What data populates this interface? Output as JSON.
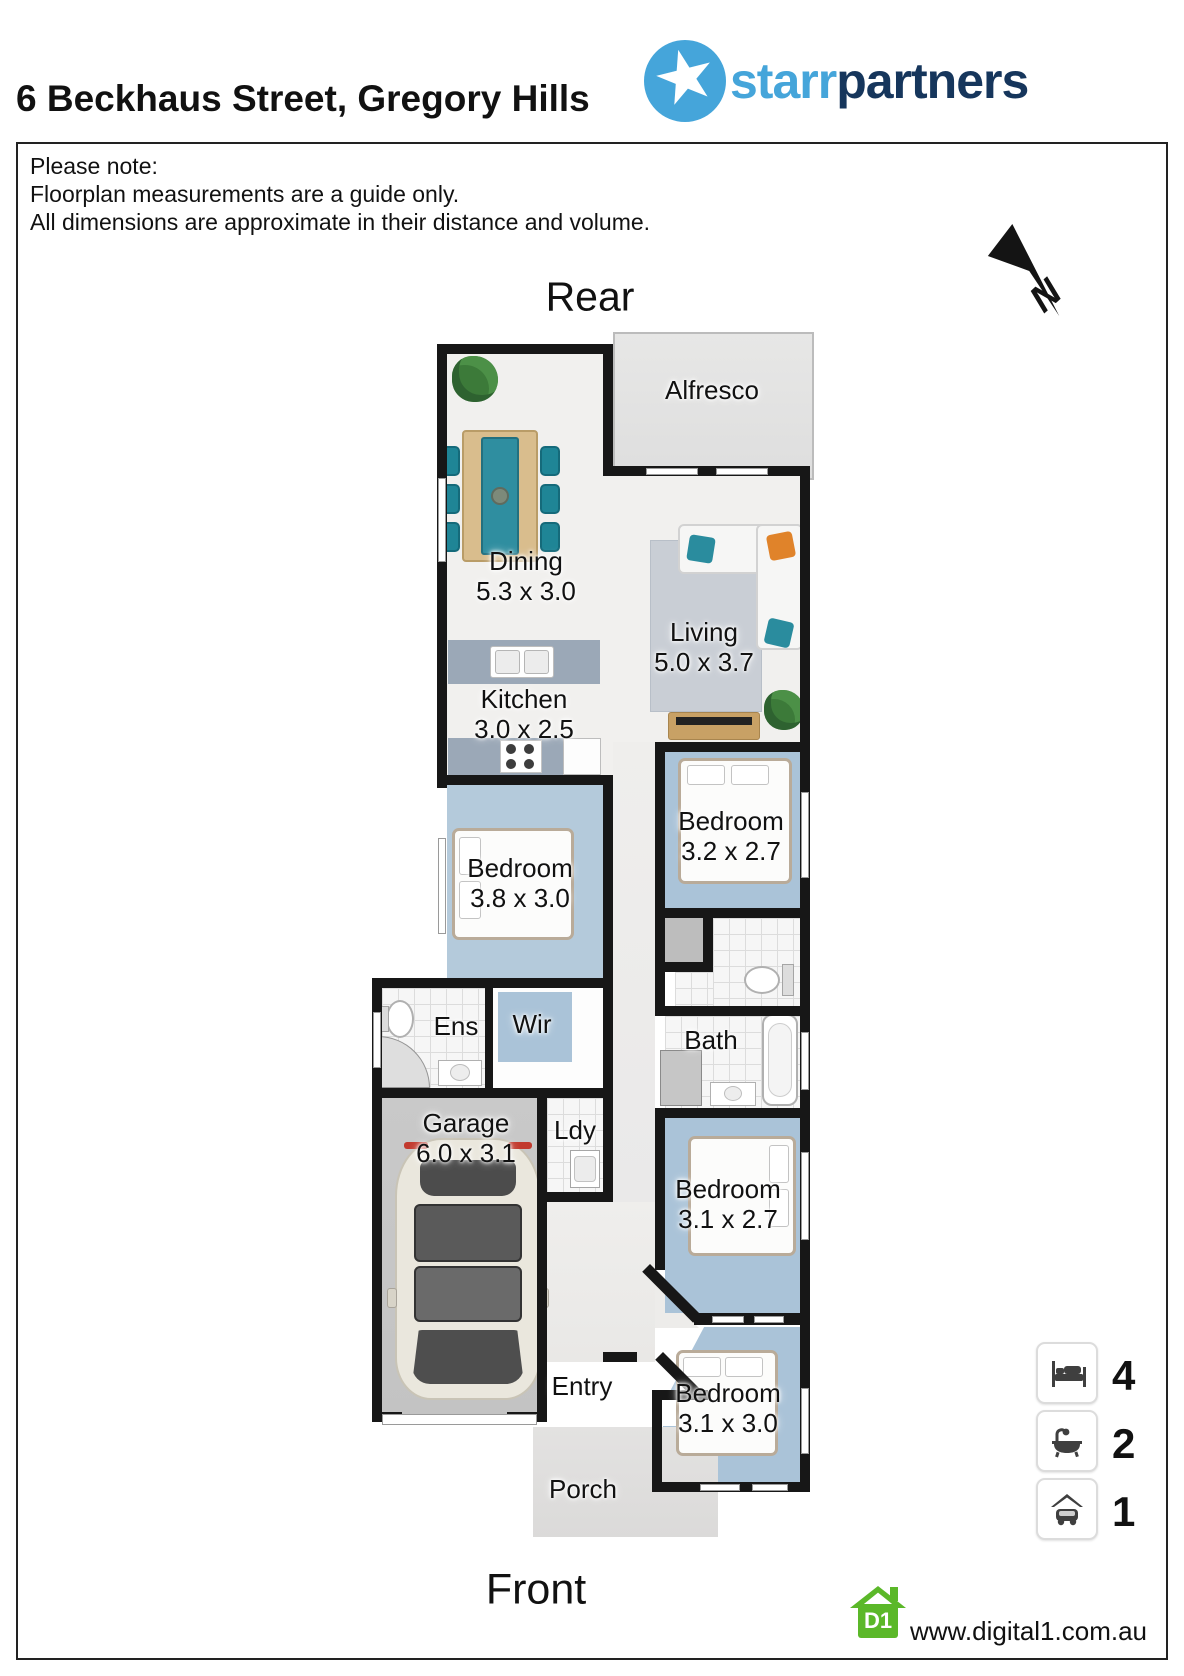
{
  "header": {
    "title": "6 Beckhaus Street, Gregory Hills",
    "logo": {
      "part1": "starr",
      "part2": "partners"
    }
  },
  "note": {
    "lines": [
      "Please note:",
      "Floorplan measurements are a guide only.",
      "All dimensions are approximate in their distance and volume."
    ]
  },
  "compass": {
    "label": "N"
  },
  "plan": {
    "rear_label": "Rear",
    "front_label": "Front",
    "rooms": [
      {
        "name": "Alfresco"
      },
      {
        "name": "Dining",
        "dims": "5.3 x 3.0"
      },
      {
        "name": "Living",
        "dims": "5.0 x 3.7"
      },
      {
        "name": "Kitchen",
        "dims": "3.0 x 2.5"
      },
      {
        "name": "Bedroom",
        "dims": "3.8 x 3.0"
      },
      {
        "name": "Bedroom",
        "dims": "3.2 x 2.7"
      },
      {
        "name": "Ens"
      },
      {
        "name": "Wir"
      },
      {
        "name": "Bath"
      },
      {
        "name": "Garage",
        "dims": "6.0 x 3.1"
      },
      {
        "name": "Ldy"
      },
      {
        "name": "Bedroom",
        "dims": "3.1 x 2.7"
      },
      {
        "name": "Entry"
      },
      {
        "name": "Bedroom",
        "dims": "3.1 x 3.0"
      },
      {
        "name": "Porch"
      }
    ]
  },
  "legend": {
    "items": [
      {
        "icon": "bed-icon",
        "count": "4"
      },
      {
        "icon": "bath-icon",
        "count": "2"
      },
      {
        "icon": "car-icon",
        "count": "1"
      }
    ]
  },
  "footer": {
    "logo_text": "D1",
    "url": "www.digital1.com.au"
  },
  "colors": {
    "logo_blue": "#45a5da",
    "logo_navy": "#16365c",
    "wall": "#171717",
    "bedroom_floor": "#aac3d8",
    "teal_accent": "#1f8596",
    "orange_accent": "#e0832a",
    "digital1_green": "#5bb829"
  }
}
